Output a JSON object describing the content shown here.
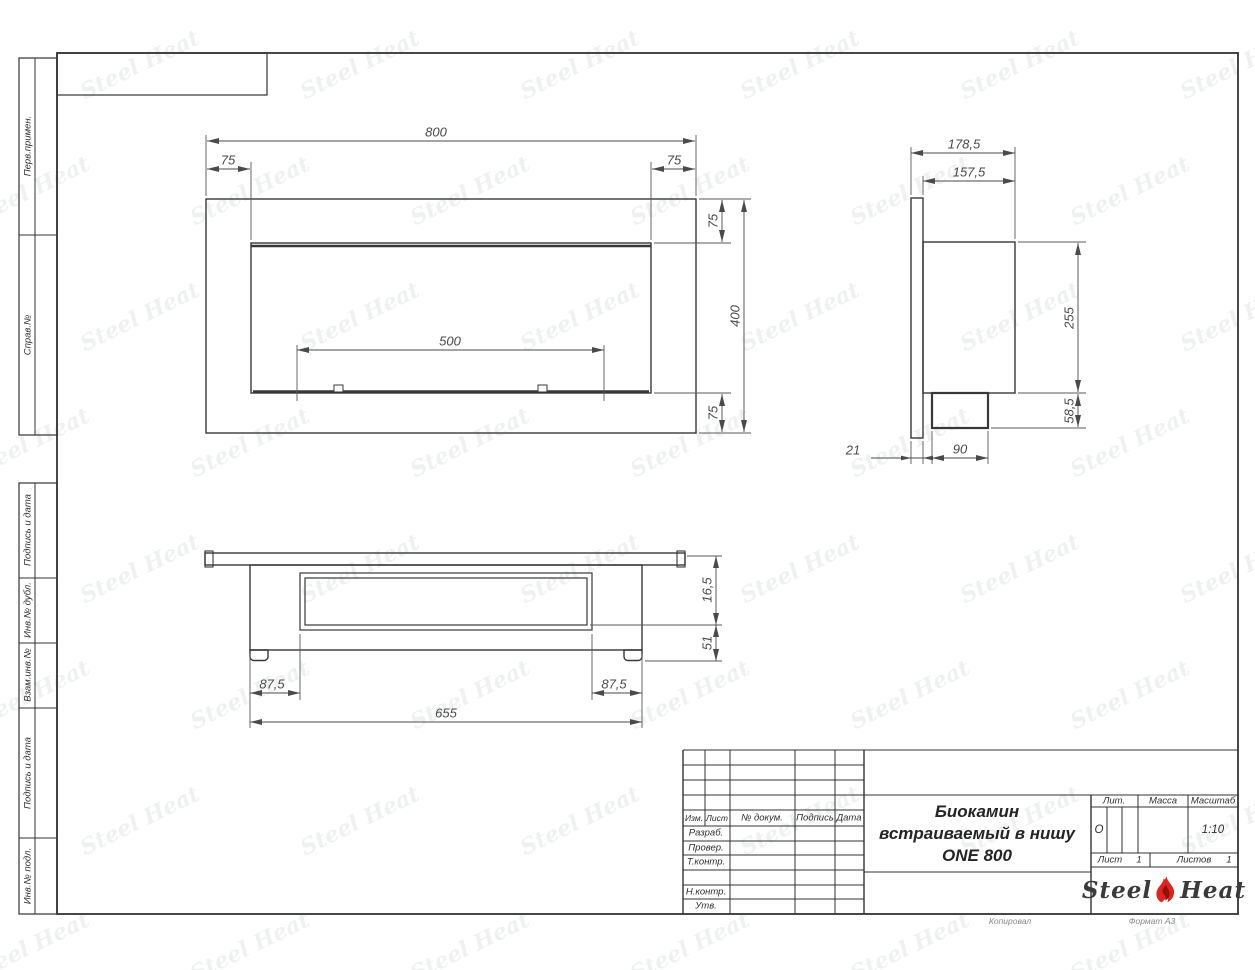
{
  "page": {
    "footer": {
      "copied_label": "Копировал",
      "format_label": "Формат А3"
    }
  },
  "watermark": {
    "text": "Steel Heat"
  },
  "sidebar": {
    "items": [
      {
        "label": "Перв.примен."
      },
      {
        "label": "Справ.№"
      },
      {
        "label": "Подпись и дата"
      },
      {
        "label": "Инв.№ дубл."
      },
      {
        "label": "Взам.инв.№"
      },
      {
        "label": "Подпись и дата"
      },
      {
        "label": "Инв.№ подл."
      }
    ]
  },
  "title_block": {
    "columns": {
      "izm": "Изм.",
      "list": "Лист",
      "doc": "№ докум.",
      "sign": "Подпись",
      "date": "Дата"
    },
    "rows": {
      "developed": "Разраб.",
      "checked": "Провер.",
      "tcontrol": "Т.контр.",
      "ncontrol": "Н.контр.",
      "approved": "Утв."
    },
    "title_line1": "Биокамин",
    "title_line2": "встраиваемый в нишу",
    "title_line3": "ONE 800",
    "lit_label": "Лит.",
    "lit_value": "О",
    "mass_label": "Масса",
    "scale_label": "Масштаб",
    "scale_value": "1:10",
    "sheet_label": "Лист",
    "sheet_value": "1",
    "sheets_label": "Листов",
    "sheets_value": "1",
    "brand": {
      "steel": "Steel",
      "heat": "Heat"
    }
  },
  "dimensions": {
    "front_view": {
      "total_width": "800",
      "left_offset": "75",
      "right_offset": "75",
      "burner_width": "500",
      "top_offset": "75",
      "total_height": "400",
      "bottom_offset": "75"
    },
    "side_view": {
      "total_depth": "178,5",
      "body_depth": "157,5",
      "body_height": "255",
      "bottom_height": "58,5",
      "flange_thickness": "21",
      "box_depth": "90"
    },
    "bottom_view": {
      "glass_offset": "16,5",
      "inner_depth": "51",
      "left_margin": "87,5",
      "right_margin": "87,5",
      "niche_width": "655"
    }
  }
}
